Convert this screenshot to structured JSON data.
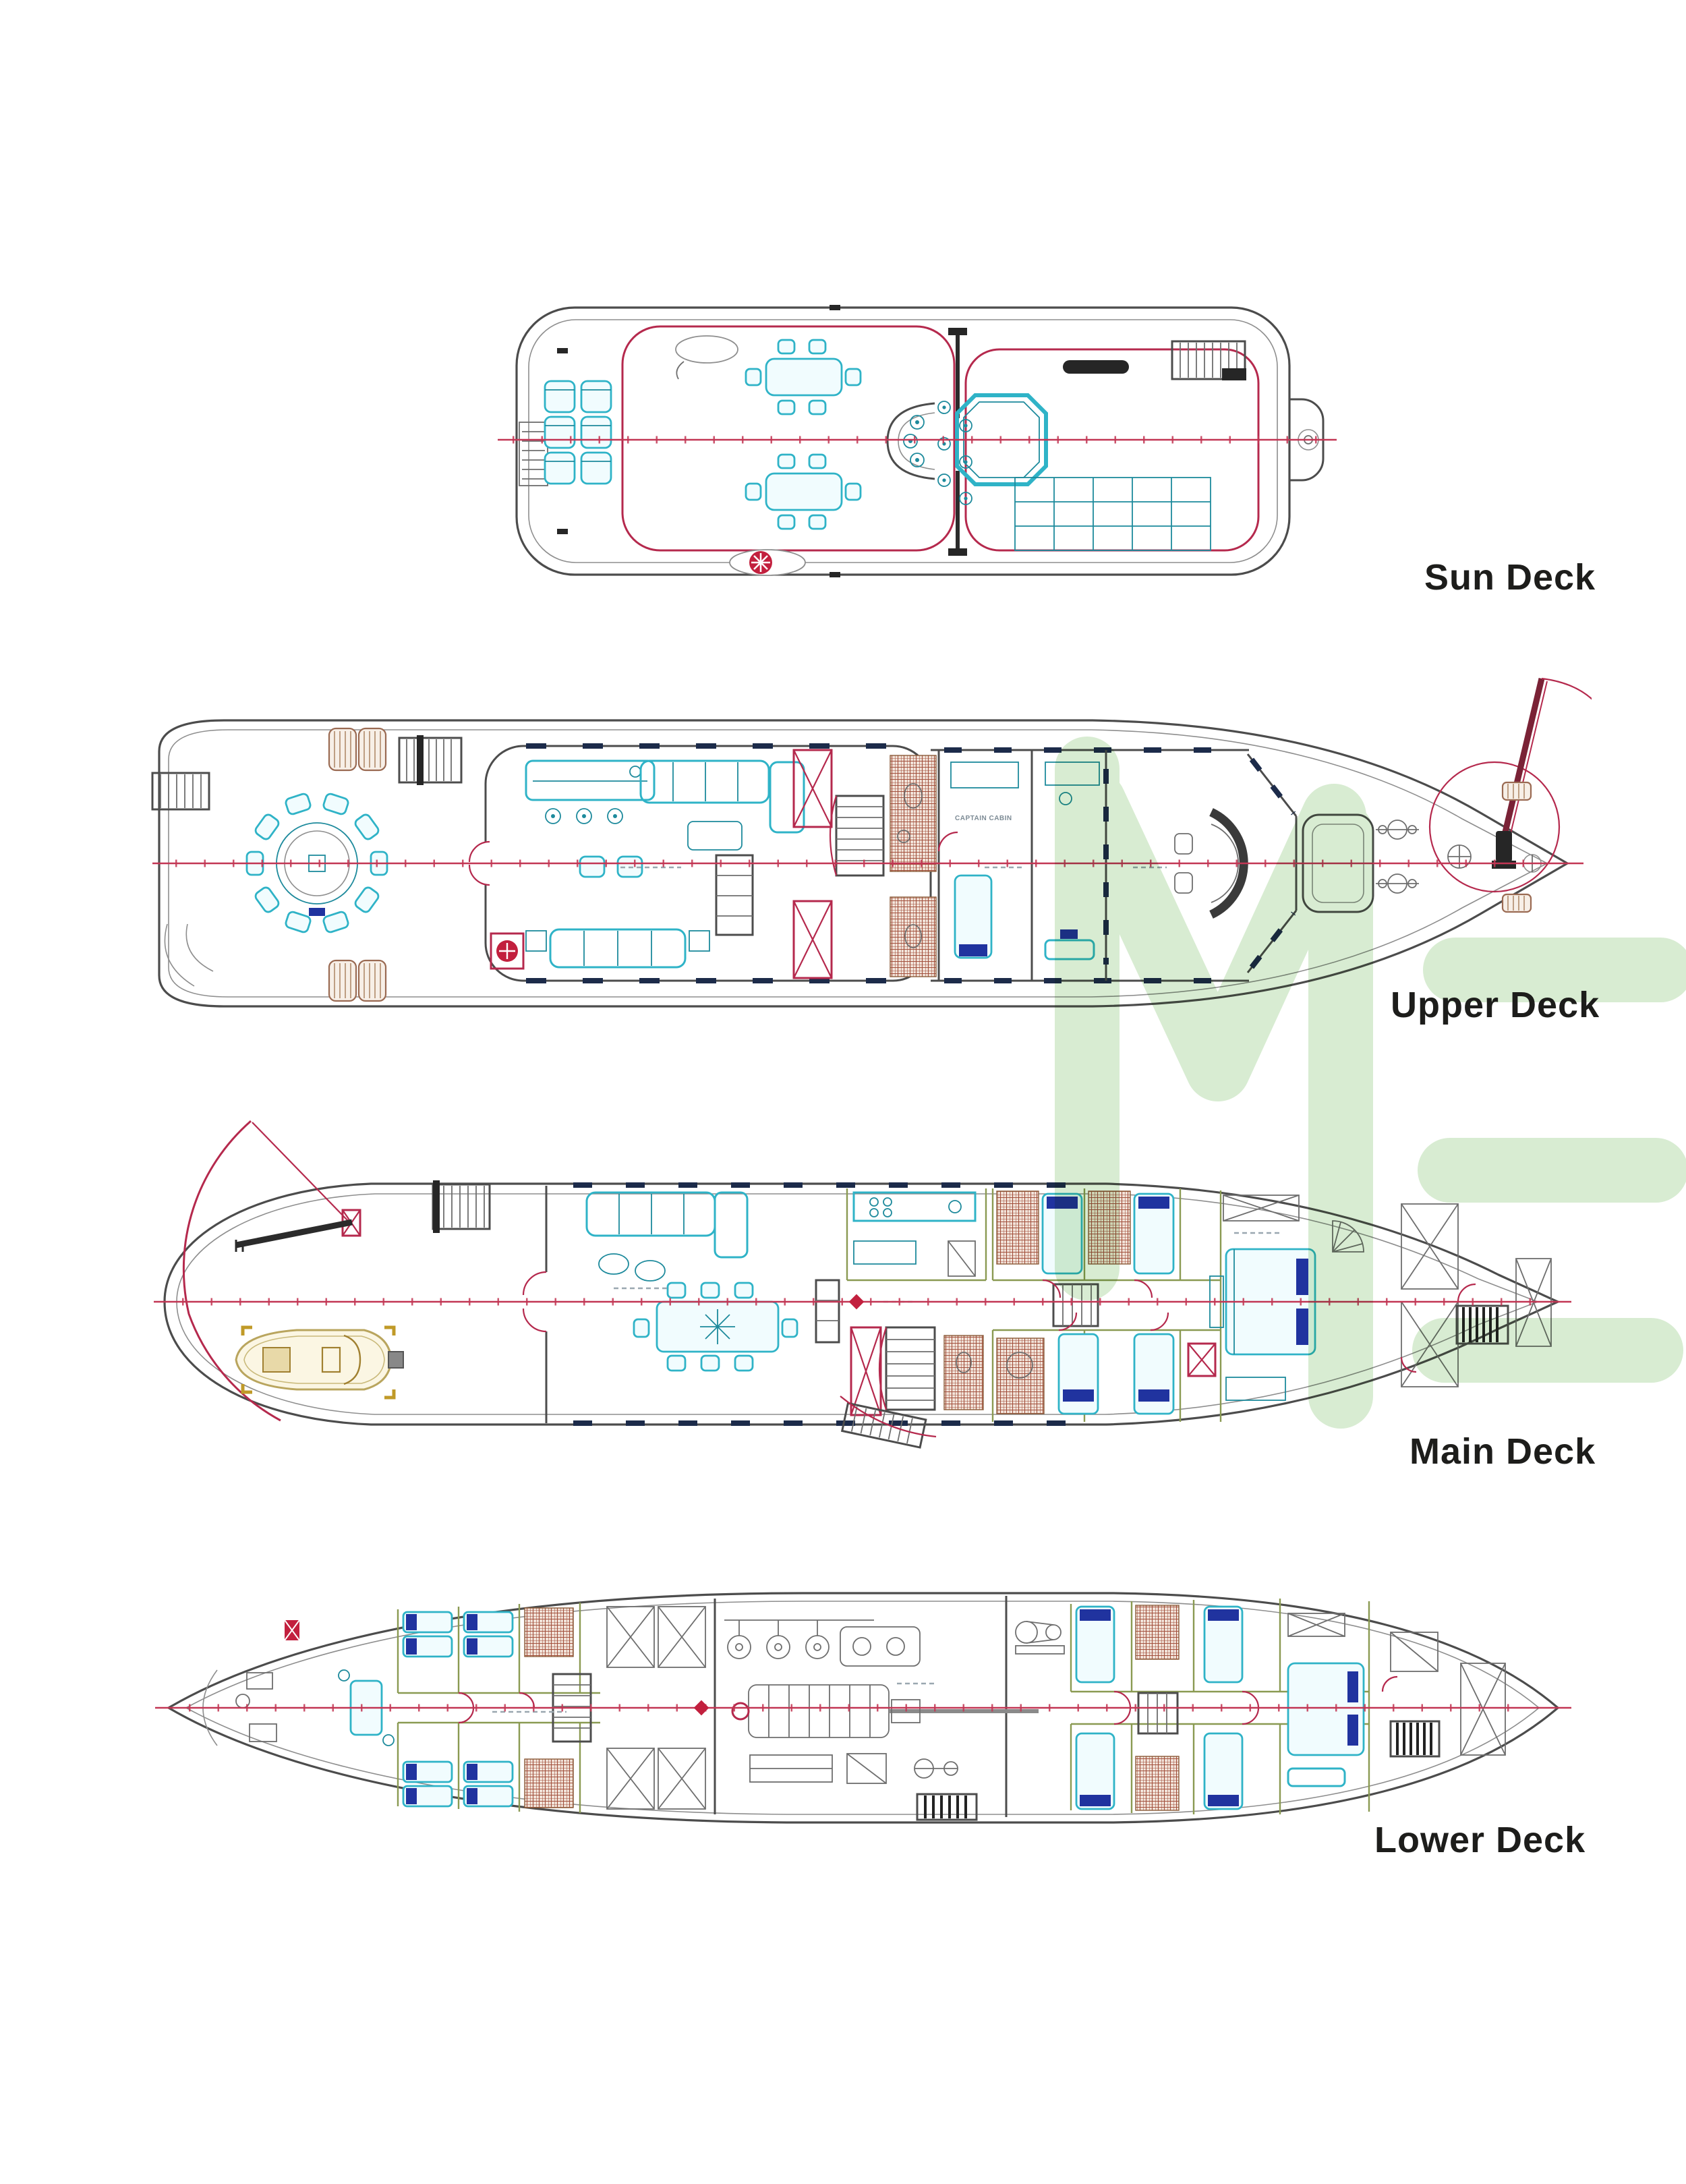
{
  "decks": [
    {
      "id": "sun-deck",
      "label": "Sun Deck"
    },
    {
      "id": "upper-deck",
      "label": "Upper Deck"
    },
    {
      "id": "main-deck",
      "label": "Main Deck"
    },
    {
      "id": "lower-deck",
      "label": "Lower Deck"
    }
  ],
  "rooms": {
    "captain_cabin": "CAPTAIN CABIN"
  },
  "watermark": {
    "text": "ME"
  },
  "colors": {
    "background": "#ffffff",
    "hull_gray": "#4c4c4c",
    "centerline_red": "#c23654",
    "furniture_teal": "#2fb3c7",
    "pillow_navy": "#20339f",
    "tile_brown": "#a2503c",
    "wall_olive": "#8a9a52",
    "tender_tan": "#b9a55e",
    "watermark_green": "#d8ecd2",
    "label_text": "#1d1d1b"
  }
}
